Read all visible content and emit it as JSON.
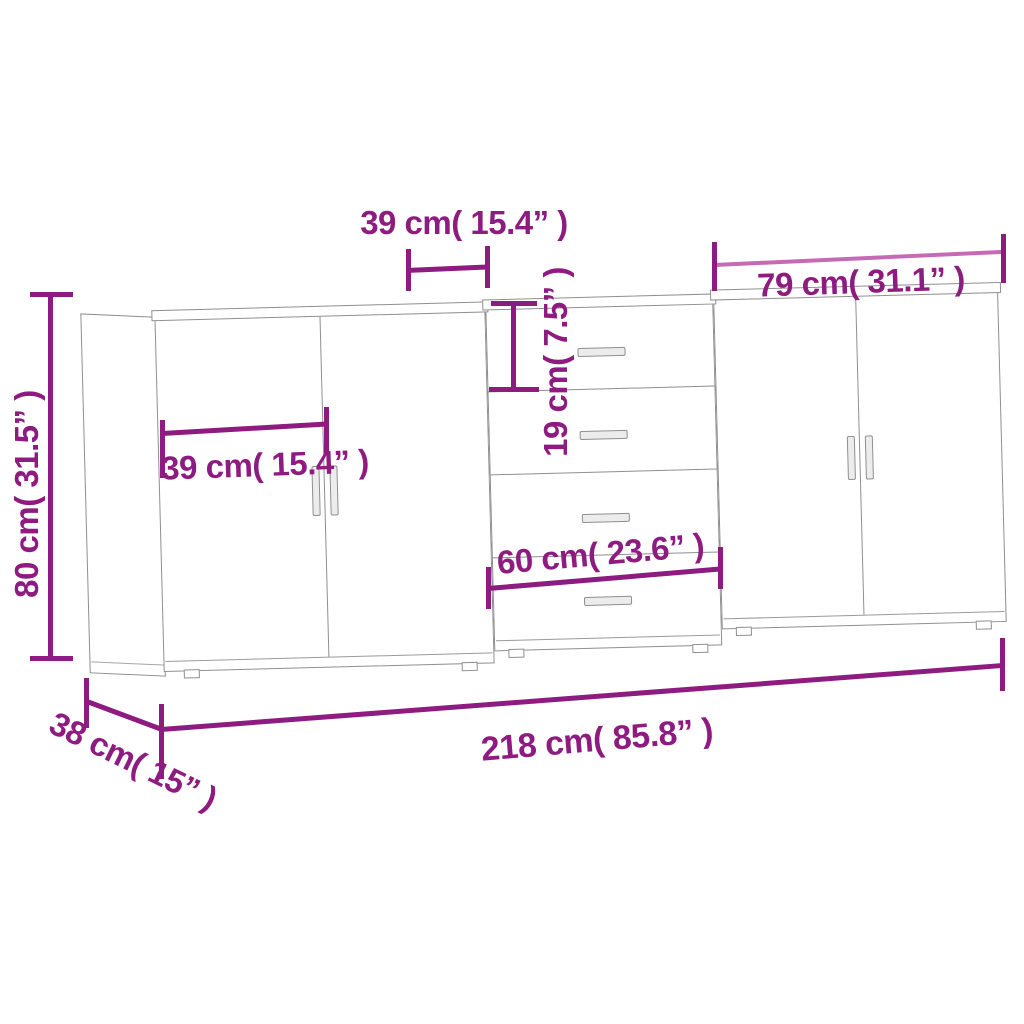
{
  "diagram": {
    "kind": "furniture-dimension-diagram",
    "product": "three sideboards placed side by side (two door cabinets and one drawer cabinet)",
    "dimensions": {
      "top_door_width": "39 cm( 15.4” )",
      "right_unit_width": "79 cm( 31.1” )",
      "height": "80 cm( 31.5” )",
      "left_door_width": "39 cm( 15.4” )",
      "drawer_height": "19 cm( 7.5” )",
      "drawer_width": "60 cm( 23.6” )",
      "total_width": "218 cm( 85.8” )",
      "depth": "38 cm( 15” )"
    },
    "units": [
      {
        "name": "left-sideboard",
        "type": "2-door cabinet"
      },
      {
        "name": "middle-sideboard",
        "type": "4-drawer cabinet"
      },
      {
        "name": "right-sideboard",
        "type": "2-door cabinet"
      }
    ],
    "colors": {
      "dimension": "#8e1b80",
      "dimension_light": "#c56ab5",
      "outline": "#8f8f8f",
      "background": "#ffffff"
    }
  }
}
